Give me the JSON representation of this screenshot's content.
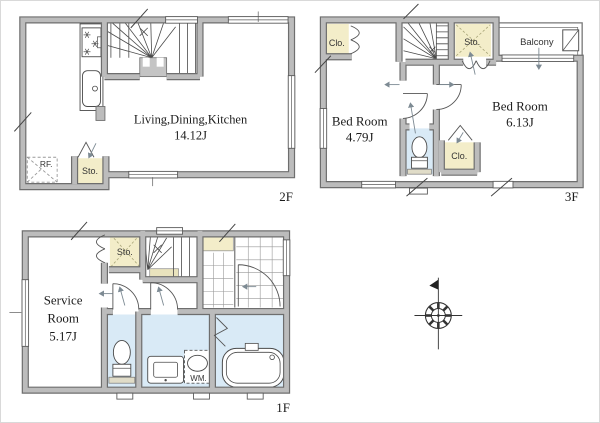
{
  "image": {
    "type": "architectural-floor-plan",
    "background": "#ffffff"
  },
  "colors": {
    "wall_fill": "#bcbcbc",
    "wall_edge": "#6e6e6e",
    "storage_fill": "#f3edc9",
    "wet_area_fill": "#d9eaf6",
    "line": "#555555"
  },
  "floor2": {
    "floor_label": "2F",
    "ldk_name": "Living,Dining,Kitchen",
    "ldk_area": "14.12J",
    "storage_label": "Sto.",
    "refrigerator_label": "RF."
  },
  "floor3": {
    "floor_label": "3F",
    "bedroom_small_name": "Bed Room",
    "bedroom_small_area": "4.79J",
    "bedroom_large_name": "Bed Room",
    "bedroom_large_area": "6.13J",
    "closet_top_label": "Clo.",
    "closet_bottom_label": "Clo.",
    "storage_label": "Sto.",
    "balcony_label": "Balcony"
  },
  "floor1": {
    "floor_label": "1F",
    "service_name_line1": "Service",
    "service_name_line2": "Room",
    "service_area": "5.17J",
    "storage_label": "Sto.",
    "washer_label": "WM."
  }
}
